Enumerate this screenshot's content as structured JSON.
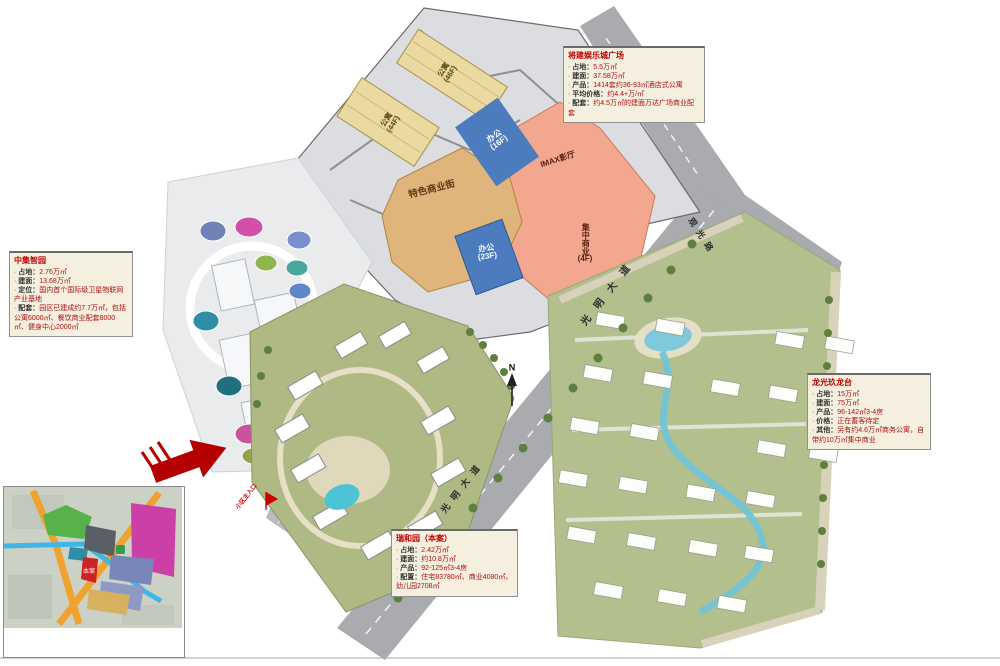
{
  "infoboxes": {
    "top_right": {
      "title": "将建娱乐城广场",
      "lines": [
        {
          "k": "占地",
          "v": "5.5万㎡"
        },
        {
          "k": "建面",
          "v": "37.58万㎡"
        },
        {
          "k": "产品",
          "v": "1414套约36-93㎡酒店式公寓"
        },
        {
          "k": "平均价格",
          "v": "约4.4+万/㎡"
        },
        {
          "k": "配套",
          "v": "约4.5万㎡的建面万达广场商业配套"
        }
      ]
    },
    "left": {
      "title": "中集智园",
      "lines": [
        {
          "k": "占地",
          "v": "2.76万㎡"
        },
        {
          "k": "建面",
          "v": "13.68万㎡"
        },
        {
          "k": "定位",
          "v": "国内首个国际级卫星物联网产业基地"
        },
        {
          "k": "配套",
          "v": "园区已建成约7.7万㎡，包括公寓6000㎡、餐饮商业配套8000㎡、健身中心2000㎡"
        }
      ]
    },
    "right": {
      "title": "龙光玖龙台",
      "lines": [
        {
          "k": "占地",
          "v": "15万㎡"
        },
        {
          "k": "建面",
          "v": "75万㎡"
        },
        {
          "k": "产品",
          "v": "96-142㎡3-4房"
        },
        {
          "k": "价格",
          "v": "正在蓄客待定"
        },
        {
          "k": "其他",
          "v": "另有约4.6万㎡商务公寓，自带约10万㎡集中商业"
        }
      ]
    },
    "bottom": {
      "title": "瑞和园（本案）",
      "lines": [
        {
          "k": "占地",
          "v": "2.42万㎡"
        },
        {
          "k": "建面",
          "v": "约10.8万㎡"
        },
        {
          "k": "产品",
          "v": "92-125㎡3-4房"
        },
        {
          "k": "配置",
          "v": "住宅83780㎡、商业4080㎡、幼儿园2708㎡"
        }
      ]
    }
  },
  "parcels": {
    "apartment_a": {
      "name": "公寓",
      "floor": "(46F)"
    },
    "apartment_b": {
      "name": "公寓",
      "floor": "(44F)"
    },
    "office_a": {
      "name": "办公",
      "floor": "(16F)"
    },
    "office_b": {
      "name": "办公",
      "floor": "(23F)"
    },
    "imax": {
      "name": "IMAX影厅"
    },
    "mall": {
      "name": "集中商业",
      "floor": "(4F)"
    },
    "street": {
      "name": "特色商业街"
    }
  },
  "roads": {
    "guanguang": "观光路",
    "guangming": "光明大道"
  },
  "markers": {
    "north": "N",
    "entrance": "小区主入口",
    "site": "本案"
  },
  "colors": {
    "accent_red": "#c00000",
    "apartment_fill": "#eadaa2",
    "office_fill": "#4d7cbe",
    "commercial_fill": "#f2a78e",
    "street_fill": "#dfb57b",
    "road_gray": "#a9abae",
    "green_base": "#aeb983"
  }
}
